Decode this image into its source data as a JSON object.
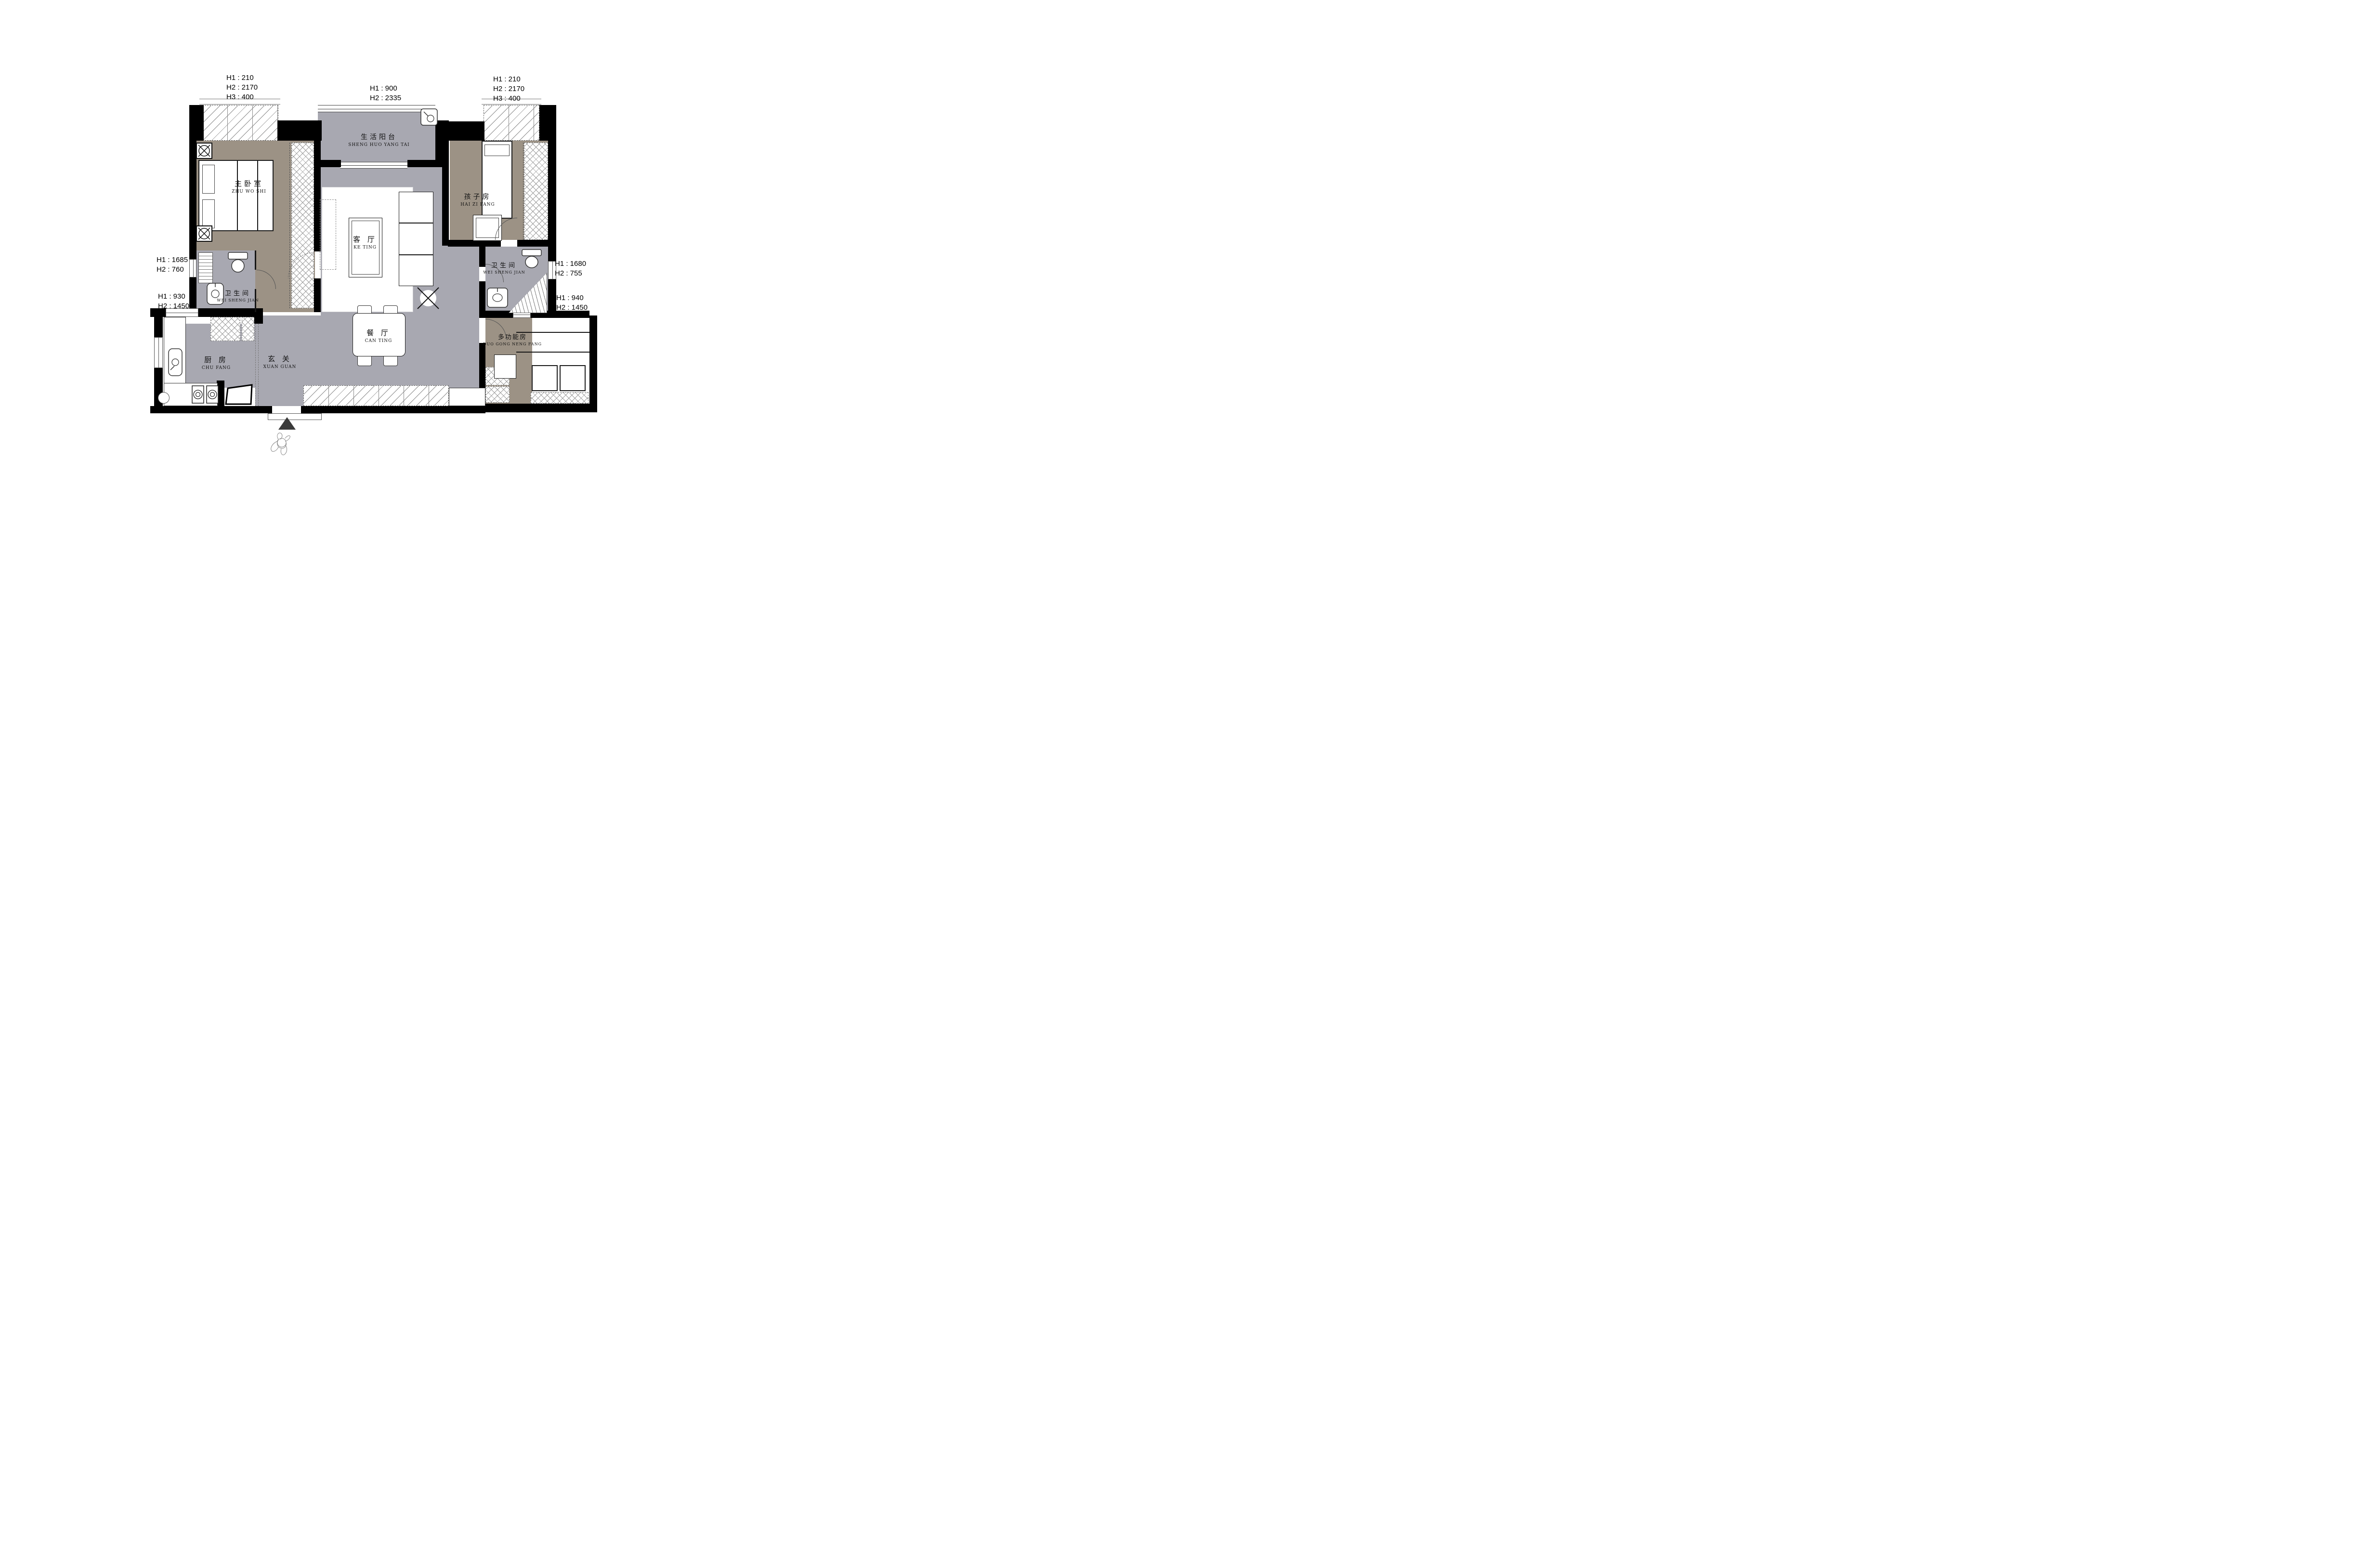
{
  "dims": {
    "top_left": [
      "H1 : 210",
      "H2 : 2170",
      "H3 : 400"
    ],
    "top_center": [
      "H1 : 900",
      "H2 : 2335"
    ],
    "top_right": [
      "H1 : 210",
      "H2 : 2170",
      "H3 : 400"
    ],
    "left_upper": [
      "H1 : 1685",
      "H2 : 760"
    ],
    "left_lower": [
      "H1 : 930",
      "H2 : 1450"
    ],
    "right_upper": [
      "H1 : 1680",
      "H2 : 755"
    ],
    "right_lower": [
      "H1 : 940",
      "H2 : 1450"
    ]
  },
  "rooms": {
    "master": {
      "zh": "主卧室",
      "en": "ZHU WO SHI"
    },
    "balcony": {
      "zh": "生活阳台",
      "en": "SHENG HUO YANG TAI"
    },
    "kids": {
      "zh": "孩子房",
      "en": "HAI ZI FANG"
    },
    "living": {
      "zh": "客 厅",
      "en": "KE TING"
    },
    "bath_left": {
      "zh": "卫生间",
      "en": "WEI SHENG JIAN"
    },
    "bath_right": {
      "zh": "卫生间",
      "en": "WEI SHENG JIAN"
    },
    "dining": {
      "zh": "餐 厅",
      "en": "CAN TING"
    },
    "kitchen": {
      "zh": "厨 房",
      "en": "CHU FANG"
    },
    "entry": {
      "zh": "玄 关",
      "en": "XUAN GUAN"
    },
    "multi": {
      "zh": "多功能房",
      "en": "DUO GONG NENG FANG"
    }
  },
  "colors": {
    "wall": "#000000",
    "floor_gray": "#a8a8b1",
    "floor_taupe": "#9c9285",
    "line": "#333333",
    "paper": "#ffffff"
  }
}
